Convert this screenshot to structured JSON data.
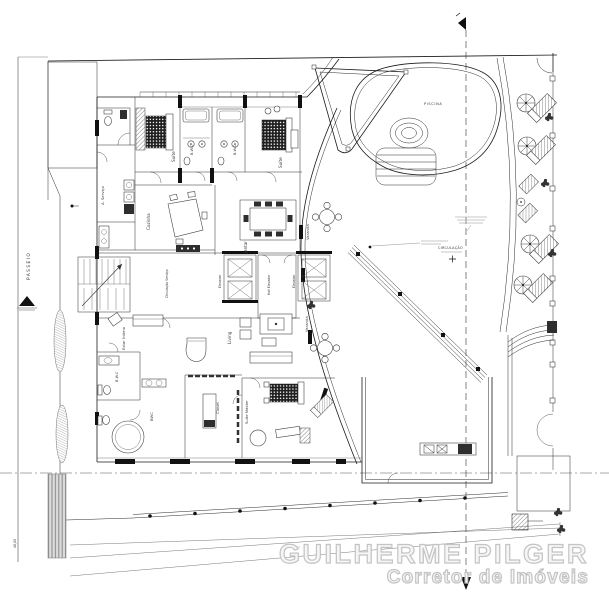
{
  "colors": {
    "background": "#ffffff",
    "linework": "#1b1b1b",
    "muted_annotation": "#b5b5b5",
    "watermark": "#c4c4c4"
  },
  "watermark": {
    "line1": "GUILHERME PILGER",
    "line2": "Corretor de Imóveis"
  },
  "site": {
    "street": "PASSEIO",
    "left_dimension": "48,00",
    "piscina": "PISCINA",
    "circulacao": "CIRCULAÇÃO"
  },
  "labels": {
    "a_servico": "A. Serviço",
    "suite_1": "Suíte",
    "bwc_1": "B.W.C",
    "bwc_2": "B.W.C",
    "suite_2": "Suíte",
    "cozinha": "Cozinha",
    "jantar": "Jantar",
    "varanda_1": "Varanda",
    "varanda_2": "Varanda",
    "circulacao_servico": "Circulação Serviço",
    "elevador_1": "Elevador",
    "hall_elevador": "Hall Elevador",
    "elevador_2": "Elevador",
    "estar_intimo": "Estar Íntimo",
    "living": "Living",
    "bwc_3": "B.W.C",
    "bwc_master": "BWC",
    "closet": "Closet",
    "suite_master": "Suíte Máster"
  }
}
